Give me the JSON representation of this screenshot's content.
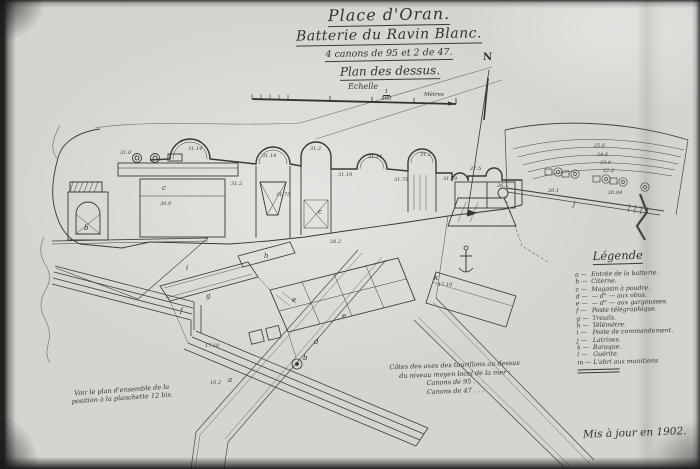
{
  "sheet": {
    "title_line1": "Place d'Oran.",
    "title_line2": "Batterie du Ravin Blanc.",
    "title_line3": "4 canons de 95 et 2 de 47.",
    "title_line4": "Plan des dessus.",
    "scale_word": "Echelle",
    "scale_num": "1",
    "scale_den": "500",
    "scale_bar_unit": "Mètres",
    "north_label": "N",
    "reference_note_line1": "Voir le plan d'ensemble de la",
    "reference_note_line2": "position à la planchette 12 bis.",
    "elevation_note_line1": "Côtes des axes des tourillons au dessus",
    "elevation_note_line2": "du niveau moyen local de la mer :",
    "elevation_note_line3": "Canons de 95 . . .",
    "elevation_note_line4": "Canons de 47 . . .",
    "date_note": "Mis à jour en 1902.",
    "colors": {
      "ink": "#34322b",
      "paper": "#d6d4d0"
    }
  },
  "legend": {
    "title": "Légende",
    "items": [
      {
        "key": "a",
        "label": "Entrée de la batterie."
      },
      {
        "key": "b",
        "label": "Citerne."
      },
      {
        "key": "c",
        "label": "Magasin à poudre."
      },
      {
        "key": "d",
        "label": "— d° — aux obus."
      },
      {
        "key": "e",
        "label": "— d° — aux gargousses."
      },
      {
        "key": "f",
        "label": "Poste télégraphique."
      },
      {
        "key": "g",
        "label": "Treuils."
      },
      {
        "key": "h",
        "label": "Télémètre."
      },
      {
        "key": "i",
        "label": "Poste de commandement."
      },
      {
        "key": "j",
        "label": "Latrines."
      },
      {
        "key": "k",
        "label": "Baraque."
      },
      {
        "key": "l",
        "label": "Guérite."
      },
      {
        "key": "m",
        "label": "L'abri aux munitions."
      }
    ]
  },
  "plan": {
    "spot_elevations": [
      {
        "x": 120,
        "y": 154,
        "v": "31.0"
      },
      {
        "x": 188,
        "y": 150,
        "v": "31.14"
      },
      {
        "x": 231,
        "y": 185,
        "v": "31.2"
      },
      {
        "x": 262,
        "y": 157,
        "v": "31.14"
      },
      {
        "x": 276,
        "y": 196,
        "v": "31.75"
      },
      {
        "x": 310,
        "y": 150,
        "v": "31.2"
      },
      {
        "x": 338,
        "y": 176,
        "v": "31.19"
      },
      {
        "x": 368,
        "y": 158,
        "v": "31.14"
      },
      {
        "x": 394,
        "y": 181,
        "v": "31.75"
      },
      {
        "x": 420,
        "y": 156,
        "v": "31.2"
      },
      {
        "x": 443,
        "y": 180,
        "v": "31.19"
      },
      {
        "x": 470,
        "y": 170,
        "v": "27.5"
      },
      {
        "x": 497,
        "y": 187,
        "v": "26.1"
      },
      {
        "x": 160,
        "y": 205,
        "v": "30.9"
      },
      {
        "x": 330,
        "y": 243,
        "v": "28.2"
      },
      {
        "x": 205,
        "y": 347,
        "v": "17.10"
      },
      {
        "x": 438,
        "y": 286,
        "v": "17.10"
      },
      {
        "x": 210,
        "y": 384,
        "v": "10.2"
      },
      {
        "x": 548,
        "y": 192,
        "v": "20.1"
      },
      {
        "x": 608,
        "y": 194,
        "v": "20.04"
      }
    ],
    "contour_labels": [
      {
        "x": 594,
        "y": 147,
        "v": "25.6"
      },
      {
        "x": 597,
        "y": 156,
        "v": "24.6"
      },
      {
        "x": 600,
        "y": 164,
        "v": "23.6"
      },
      {
        "x": 603,
        "y": 172,
        "v": "22.6"
      }
    ],
    "letters": [
      {
        "x": 84,
        "y": 230,
        "v": "b"
      },
      {
        "x": 162,
        "y": 190,
        "v": "c"
      },
      {
        "x": 318,
        "y": 214,
        "v": "c"
      },
      {
        "x": 186,
        "y": 270,
        "v": "i"
      },
      {
        "x": 206,
        "y": 298,
        "v": "g"
      },
      {
        "x": 264,
        "y": 258,
        "v": "h"
      },
      {
        "x": 180,
        "y": 313,
        "v": "f"
      },
      {
        "x": 292,
        "y": 302,
        "v": "e"
      },
      {
        "x": 342,
        "y": 318,
        "v": "e"
      },
      {
        "x": 314,
        "y": 344,
        "v": "d"
      },
      {
        "x": 228,
        "y": 382,
        "v": "a"
      },
      {
        "x": 303,
        "y": 360,
        "v": "b"
      },
      {
        "x": 434,
        "y": 280,
        "v": "k"
      },
      {
        "x": 573,
        "y": 206,
        "v": "j"
      }
    ]
  }
}
